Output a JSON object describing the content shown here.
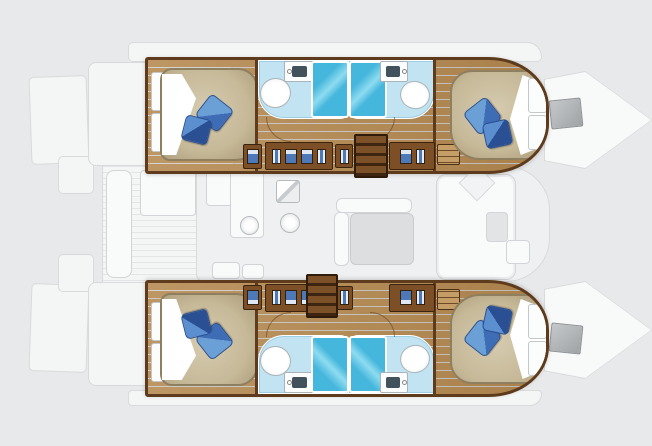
{
  "meta": {
    "title": "Catamaran 4-cabin layout floor plan",
    "canvas_width_px": 652,
    "canvas_height_px": 446,
    "visible_text": []
  },
  "colors": {
    "bg": "#e8e9ea",
    "deck_fill": "#f4f5f5",
    "ghost_line": "#d8dadc",
    "plank_line": "#e4e5e7",
    "salon_fill": "#eff0f1",
    "furn_fill": "#f9fafa",
    "furn_line": "#d2d5d7",
    "table_gray": "#dcdedf",
    "wood": "#b4884f",
    "wood_dark": "#996f3e",
    "wood_light": "#c59d66",
    "trim": "#5e3b1d",
    "locker": "#7c4f27",
    "stair_dark": "#3e2512",
    "stair_tread": "#7d5127",
    "mattress_edge": "#8d7f60",
    "sheet": "#fdfdfd",
    "pillow": "#3f6db5",
    "pillow_light": "#6ba0d6",
    "pillow_dark": "#2a4f92",
    "bath_floor": "#c2e4f2",
    "bath_edge": "#9ccde2",
    "shower": "#45b6dc",
    "shower_light": "#8edcf0",
    "fixture_line": "#aab3b8",
    "basin": "#42525c",
    "hatch_a": "#c6c9cb",
    "hatch_b": "#9fa3a5"
  },
  "boat": {
    "type": "catamaran",
    "view": "top-down interior floor plan, bow to the right",
    "hulls": [
      {
        "id": "top-hull",
        "rooms": [
          "aft double cabin",
          "aft head with shower",
          "forward head with shower",
          "forward double cabin"
        ]
      },
      {
        "id": "bottom-hull",
        "rooms": [
          "aft double cabin",
          "aft head with shower",
          "forward head with shower",
          "forward double cabin"
        ]
      }
    ],
    "cabin_features": [
      "island double berth",
      "white turned-down sheet",
      "two blue pillows",
      "hull window panels",
      "wardrobe lockers",
      "drawer unit"
    ],
    "head_features": [
      "toilet",
      "washbasin counter",
      "separate glass shower",
      "light-blue floor",
      "swing door"
    ],
    "salon_features": [
      "galley counters",
      "stove",
      "round sink",
      "fridge",
      "dinette table with seating",
      "forward sofa with cushion",
      "side table",
      "console"
    ],
    "deck_features": [
      "aft cockpit teak deck",
      "cockpit table",
      "aft bench",
      "swim platforms with steps",
      "side decks",
      "bow deck hatches",
      "companionway stairs per hull"
    ]
  }
}
